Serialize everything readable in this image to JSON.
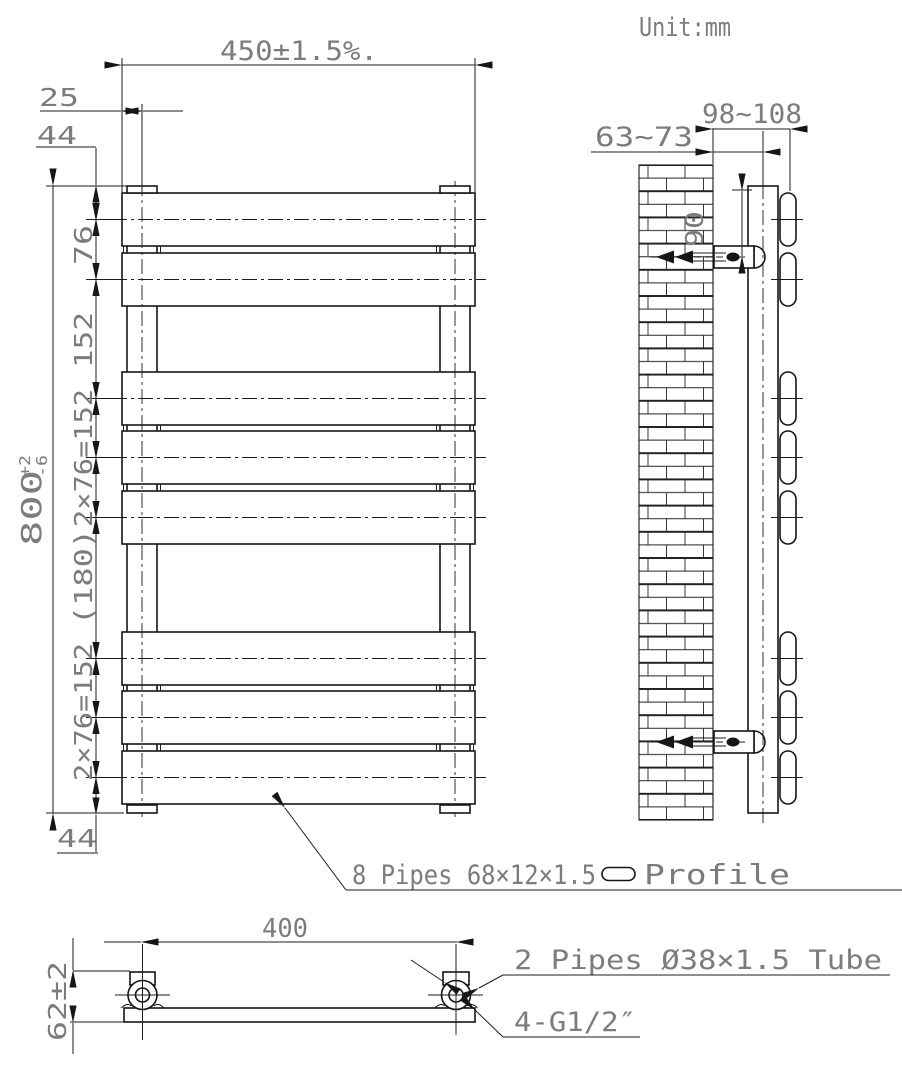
{
  "unit_note": "Unit:mm",
  "front_view": {
    "width_dim": "450±1.5%.",
    "tube_inset_dim": "25",
    "top_pitch_dim": "44",
    "bottom_pitch_dim": "44",
    "height_dim_value": "800",
    "height_dim_upper_tol": "+2",
    "height_dim_lower_tol": "-6",
    "pitch_dims": [
      "76",
      "152",
      "2×76=152",
      "(180)",
      "2×76=152"
    ]
  },
  "side_view": {
    "wall_to_tube_center_dim": "63~73",
    "wall_to_panel_face_dim": "98~108",
    "tube_top_to_bracket_dim": "90"
  },
  "bottom_view": {
    "connection_spacing_dim": "400",
    "depth_dim": "62±2"
  },
  "callouts": {
    "panel_pipes": "8 Pipes 68×12×1.5",
    "panel_profile_label": "Profile",
    "round_pipes": "2 Pipes Ø38×1.5 Tube",
    "thread_spec": "4-G1/2″"
  }
}
